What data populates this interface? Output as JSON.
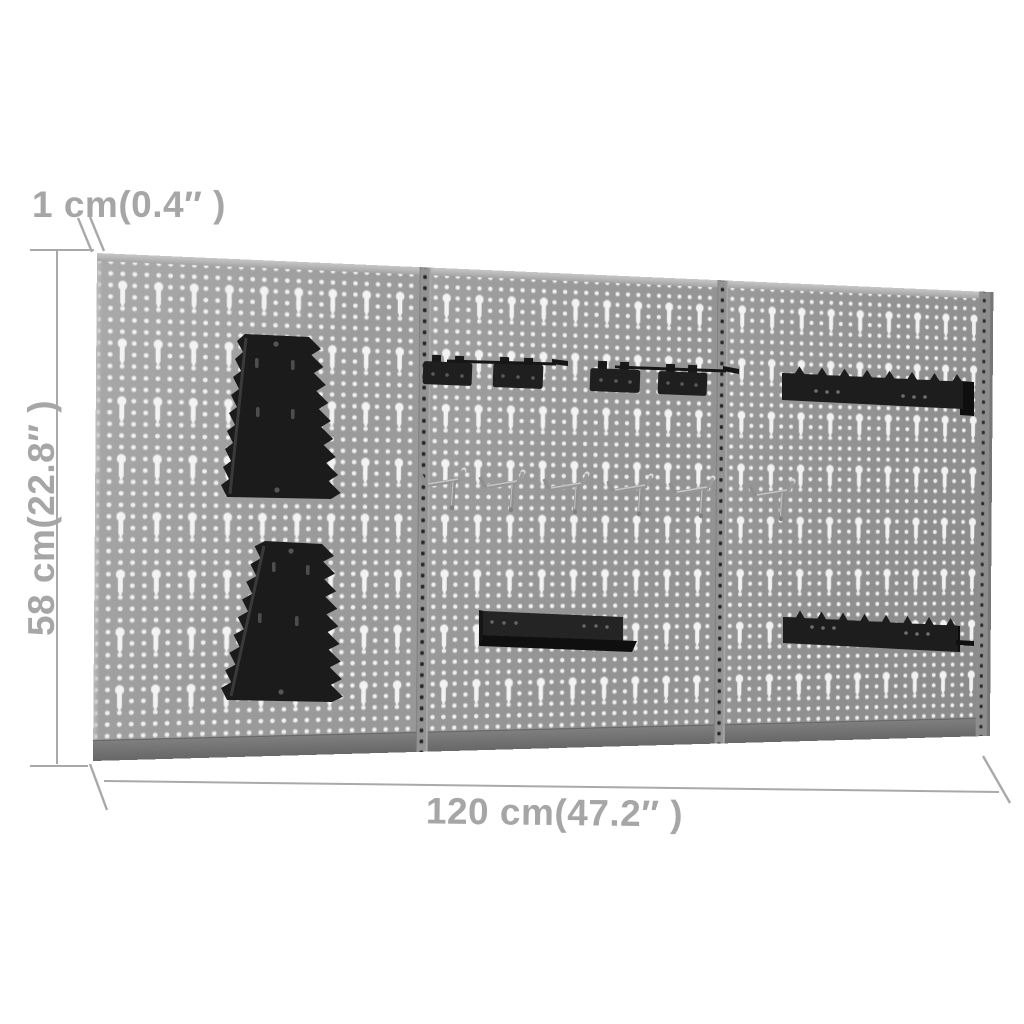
{
  "page": {
    "type": "product-dimension-diagram",
    "background_color": "#ffffff"
  },
  "dimensions": {
    "thickness_label": "1 cm(0.4″ )",
    "height_label": "58 cm(22.8″ )",
    "width_label": "120 cm(47.2″ )"
  },
  "board": {
    "panel_count": 3,
    "panel_color": "#989898",
    "hole_color": "#f2f2f2",
    "seam_dot_color": "#242424",
    "accessory_color": "#1c1c1c",
    "hook_color": "#969696",
    "accessories": [
      {
        "name": "wrench-holder",
        "count": 2
      },
      {
        "name": "tool-clamp-block",
        "count": 4
      },
      {
        "name": "tool-holder-rod",
        "count": 2
      },
      {
        "name": "metal-hook",
        "count": 6
      },
      {
        "name": "slotted-shelf",
        "count": 3
      }
    ]
  },
  "annotation": {
    "line_color": "#a9a9a9",
    "label_color": "#a6a6a6"
  }
}
